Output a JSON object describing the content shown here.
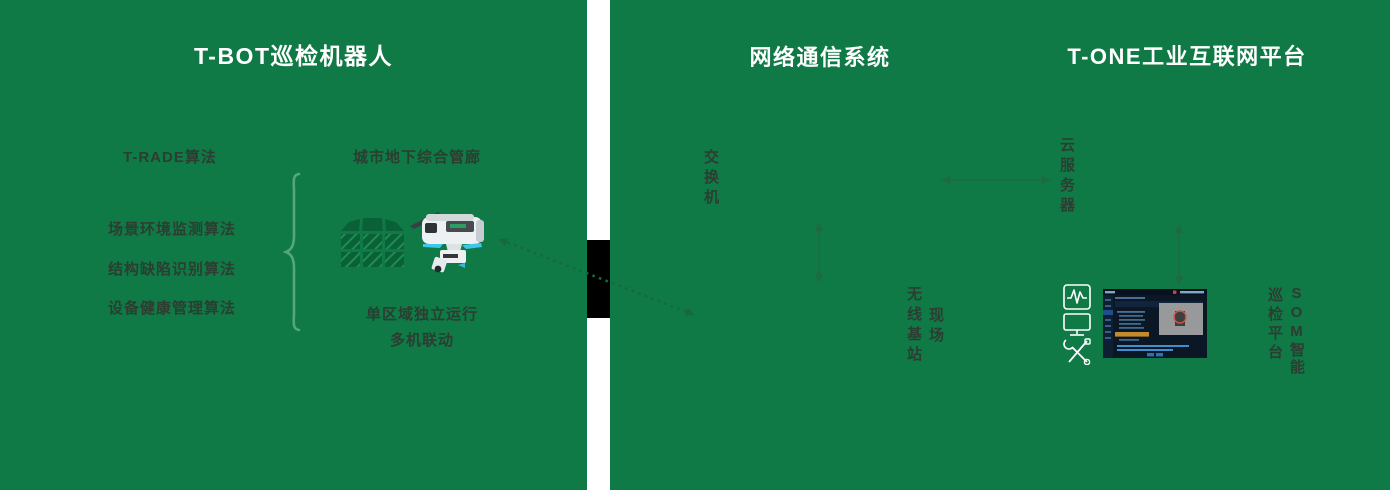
{
  "colors": {
    "panel_green": "#0f7a46",
    "label_dark": "#2c3d32",
    "arrow_green": "#1e6b42",
    "dotted_arrow_green": "#17693c",
    "brace_green": "#56a67c",
    "robot_accent_blue": "#3fc6ec",
    "gap_block_black": "#000000",
    "platform_ui_bg": "#0c1726",
    "platform_ui_highlight_orange": "#c58a2a"
  },
  "left_panel": {
    "title": "T-BOT巡检机器人",
    "algorithm_group": {
      "header": "T-RADE算法",
      "items": [
        "场景环境监测算法",
        "结构缺陷识别算法",
        "设备健康管理算法"
      ]
    },
    "scene": {
      "title": "城市地下综合管廊",
      "captions": [
        "单区域独立运行",
        "多机联动"
      ]
    }
  },
  "right_panel": {
    "network_title": "网络通信系统",
    "platform_title": "T-ONE工业互联网平台",
    "switch_label": "交换机",
    "cloud_server_label": "云服务器",
    "field_station": {
      "col_right": "现场",
      "col_left": "无线基站"
    },
    "som_platform": {
      "col_right": "SOM智能",
      "col_left": "巡检平台"
    }
  },
  "icons": {
    "tunnel_grid": "utility-tunnel-grid-icon",
    "robot": "rail-inspection-robot-icon",
    "monitor_waveform": "monitor-waveform-icon",
    "display": "display-monitor-icon",
    "tools": "crossed-tools-icon",
    "platform_screenshot": "som-platform-screenshot",
    "brace": "curly-brace"
  }
}
